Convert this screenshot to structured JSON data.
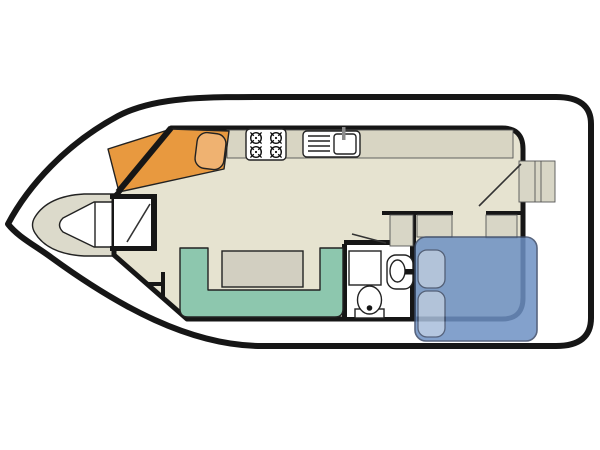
{
  "diagram": {
    "type": "boat-floor-plan",
    "subject": "Houseboat / canal boat deck layout, top-down plan view, bow pointing left",
    "colors": {
      "page_bg": "#ffffff",
      "hull_fill": "#ffffff",
      "wall": "#161616",
      "floor": "#e6e3d0",
      "counter": "#d8d5c3",
      "deck": "#dcdacb",
      "cabinet": "#d8d6c6",
      "helm_orange": "#e8993f",
      "helm_seat": "#efb271",
      "sofa_green": "#8dc7ae",
      "table": "#d2cfc1",
      "bed_blue": "#6e91c4",
      "pillow_blue": "#a9bedb",
      "bed_outline": "#3a4a68",
      "fixture_white": "#ffffff",
      "bathroom_floor": "#ffffff",
      "door_line": "#333333",
      "faucet_gray": "#8a8a8a"
    },
    "elements": [
      {
        "id": "hull",
        "label": "boat hull with pointed bow and rounded stern"
      },
      {
        "id": "bow-deck",
        "label": "bow deck platform"
      },
      {
        "id": "bow-locker",
        "label": "bow locker / foredeck seat with divider"
      },
      {
        "id": "entry-vestibule",
        "label": "bow entry room with door swing"
      },
      {
        "id": "helm-bench",
        "label": "orange helm bench with seat cushion"
      },
      {
        "id": "helm-wheel",
        "label": "steering position marker"
      },
      {
        "id": "galley-counter",
        "label": "galley worktop strip"
      },
      {
        "id": "stove",
        "label": "four-burner hob"
      },
      {
        "id": "sink",
        "label": "sink with drainer and tap"
      },
      {
        "id": "dinette-sofa",
        "label": "U-shaped dinette sofa"
      },
      {
        "id": "dinette-table",
        "label": "dinette table"
      },
      {
        "id": "bathroom",
        "label": "bathroom compartment"
      },
      {
        "id": "shower",
        "label": "shower tray with grid"
      },
      {
        "id": "washbasin",
        "label": "washbasin with tap"
      },
      {
        "id": "toilet",
        "label": "toilet"
      },
      {
        "id": "cabinet-bathroom",
        "label": "bathroom corner cabinet"
      },
      {
        "id": "cabinet-bed-left",
        "label": "cabinet left of bed"
      },
      {
        "id": "cabinet-bed-right",
        "label": "cabinet on aft cabin right wall"
      },
      {
        "id": "double-bed",
        "label": "double bed with two pillows"
      },
      {
        "id": "side-step",
        "label": "stern side boarding step"
      },
      {
        "id": "door-bathroom",
        "label": "bathroom door swing line"
      },
      {
        "id": "door-aft",
        "label": "aft cabin door swing line"
      }
    ]
  }
}
